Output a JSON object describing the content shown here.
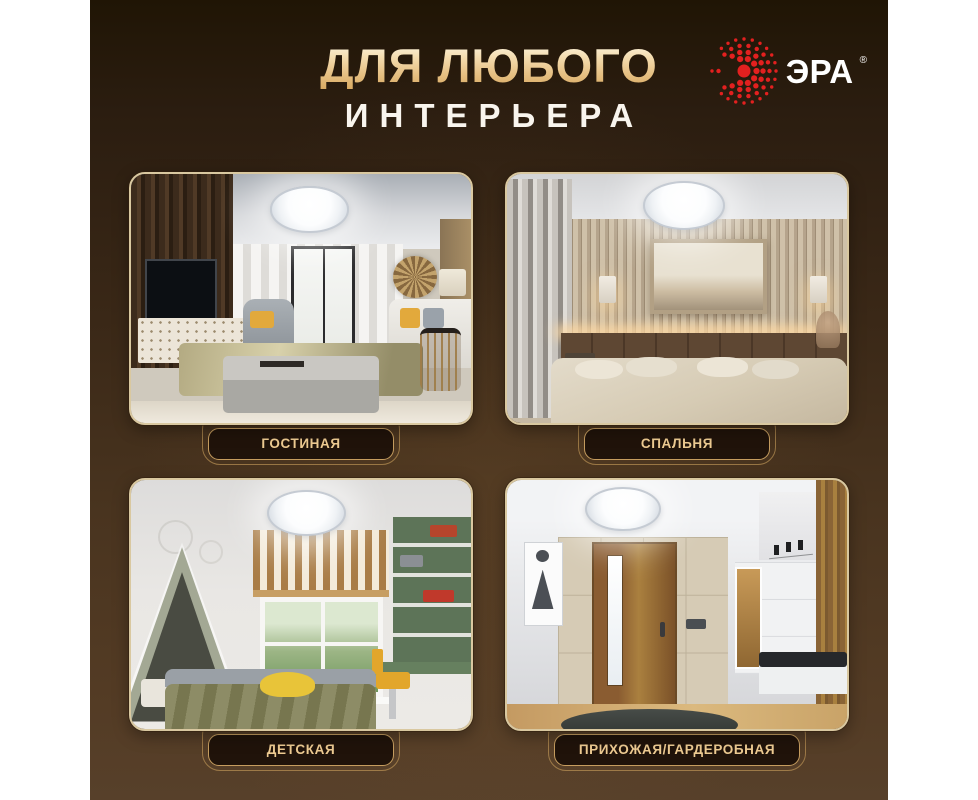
{
  "poster": {
    "header": {
      "title_line1": "ДЛЯ ЛЮБОГО",
      "title_line2": "ИНТЕРЬЕРА"
    },
    "logo": {
      "brand": "ЭРА",
      "registered": "®",
      "icon": "era-sunburst-icon"
    },
    "rooms": [
      {
        "label": "ГОСТИНАЯ"
      },
      {
        "label": "СПАЛЬНЯ"
      },
      {
        "label": "ДЕТСКАЯ"
      },
      {
        "label": "ПРИХОЖАЯ/ГАРДЕРОБНАЯ"
      }
    ],
    "colors": {
      "brand_red": "#E3201F",
      "title_gold": "#E9C58D",
      "title_white": "#F9F5EE",
      "background_top": "#241808",
      "background_bottom": "#57402A",
      "card_border": "#D9C8A0",
      "plaque_background": "#20130A",
      "plaque_border": "#C69D5F",
      "plaque_text": "#EECB92"
    }
  }
}
